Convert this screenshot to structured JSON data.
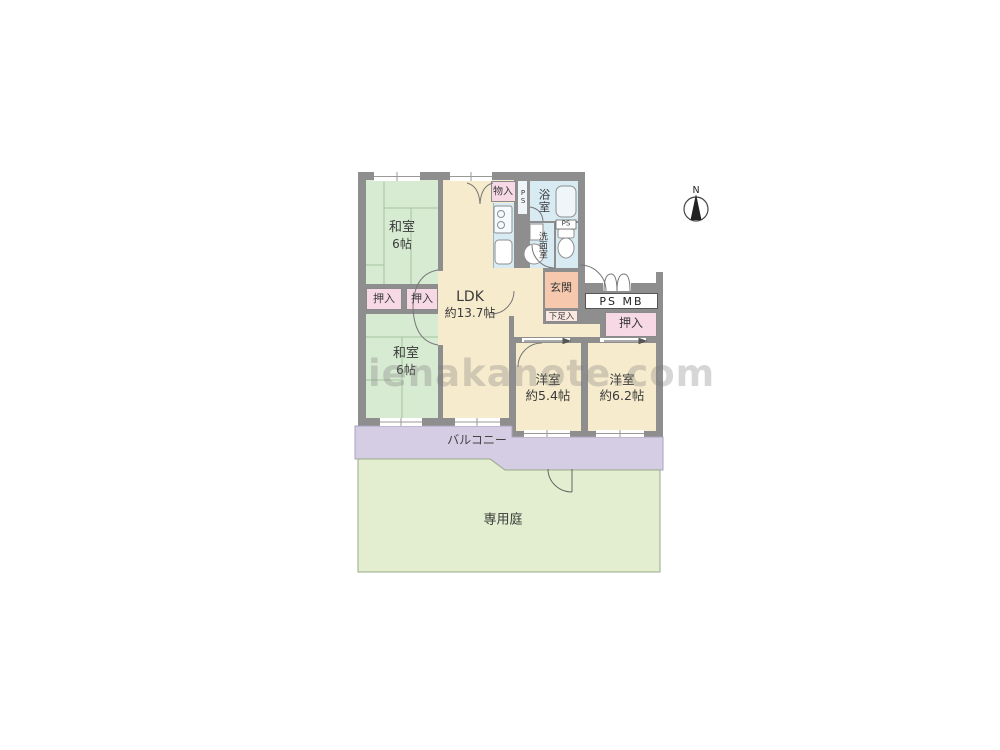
{
  "watermark": "ienakanote.com",
  "compass": {
    "north_label": "N"
  },
  "rooms": {
    "washitsu_top": {
      "name": "和室",
      "size": "6帖"
    },
    "washitsu_bottom": {
      "name": "和室",
      "size": "6帖"
    },
    "ldk": {
      "name": "LDK",
      "size": "約13.7帖"
    },
    "yoshitsu_small": {
      "name": "洋室",
      "size": "約5.4帖"
    },
    "yoshitsu_large": {
      "name": "洋室",
      "size": "約6.2帖"
    }
  },
  "labels": {
    "oshiire_left_1": "押入",
    "oshiire_left_2": "押入",
    "oshiire_right": "押入",
    "monoire": "物入",
    "bathroom": "浴室",
    "washroom": "洗面室",
    "ps_shaft": "PS",
    "ps_small": "PS",
    "ps_mb": "PS MB",
    "entrance": "玄関",
    "shoe_cabinet": "下足入",
    "balcony": "バルコニー",
    "private_garden": "専用庭"
  },
  "colors": {
    "wall": "#8e8e8e",
    "tatami_room": "#d7ead2",
    "western_room": "#f6ebcd",
    "wet_area": "#d8eaf2",
    "closet": "#f7d9e5",
    "entrance": "#f6c9ae",
    "shoe_cabinet": "#fbe8e2",
    "balcony": "#d4cde4",
    "garden": "#e2eecf"
  }
}
